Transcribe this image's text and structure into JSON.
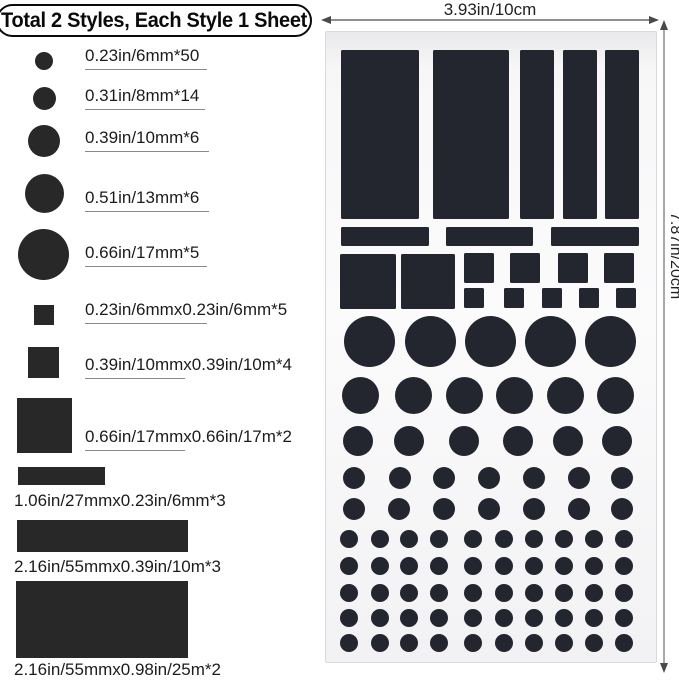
{
  "title": "Total 2 Styles, Each Style 1 Sheet",
  "colors": {
    "sticker": "#23252f",
    "legend_shape": "#282828",
    "text": "#1c1c1c",
    "underline": "#8a8a8a",
    "dimension_line": "#4a4a4a"
  },
  "legend": {
    "items": [
      {
        "label": "0.23in/6mm*50",
        "shape": "circle",
        "w": 18,
        "h": 18,
        "sx": 35,
        "sy": 52,
        "tx": 85,
        "ty": 46,
        "ul": 122
      },
      {
        "label": "0.31in/8mm*14",
        "shape": "circle",
        "w": 23,
        "h": 23,
        "sx": 33,
        "sy": 87,
        "tx": 85,
        "ty": 86,
        "ul": 120
      },
      {
        "label": "0.39in/10mm*6",
        "shape": "circle",
        "w": 32,
        "h": 32,
        "sx": 28,
        "sy": 125,
        "tx": 85,
        "ty": 128,
        "ul": 124
      },
      {
        "label": "0.51in/13mm*6",
        "shape": "circle",
        "w": 39,
        "h": 39,
        "sx": 25,
        "sy": 174,
        "tx": 85,
        "ty": 188,
        "ul": 124
      },
      {
        "label": "0.66in/17mm*5",
        "shape": "circle",
        "w": 51,
        "h": 51,
        "sx": 18,
        "sy": 229,
        "tx": 85,
        "ty": 243,
        "ul": 122
      },
      {
        "label": "0.23in/6mmx0.23in/6mm*5",
        "shape": "square",
        "w": 20,
        "h": 20,
        "sx": 34,
        "sy": 305,
        "tx": 85,
        "ty": 300,
        "ul": 122
      },
      {
        "label": "0.39in/10mmx0.39in/10m*4",
        "shape": "square",
        "w": 31,
        "h": 31,
        "sx": 28,
        "sy": 347,
        "tx": 85,
        "ty": 355,
        "ul": 100
      },
      {
        "label": "0.66in/17mmx0.66in/17m*2",
        "shape": "square",
        "w": 55,
        "h": 55,
        "sx": 17,
        "sy": 398,
        "tx": 85,
        "ty": 427,
        "ul": 100
      },
      {
        "label": "1.06in/27mmx0.23in/6mm*3",
        "shape": "rect",
        "w": 87,
        "h": 18,
        "sx": 18,
        "sy": 467,
        "tx": 14,
        "ty": 491,
        "ul": 0
      },
      {
        "label": "2.16in/55mmx0.39in/10m*3",
        "shape": "rect",
        "w": 171,
        "h": 32,
        "sx": 17,
        "sy": 520,
        "tx": 14,
        "ty": 557,
        "ul": 0
      },
      {
        "label": "2.16in/55mmx0.98in/25m*2",
        "shape": "rect",
        "w": 172,
        "h": 77,
        "sx": 16,
        "sy": 581,
        "tx": 14,
        "ty": 660,
        "ul": 0
      }
    ]
  },
  "sheet": {
    "width_label": "3.93in/10cm",
    "height_label": "7.87in/20cm",
    "rects": [
      {
        "x": 15,
        "y": 18,
        "w": 78,
        "h": 169
      },
      {
        "x": 107,
        "y": 18,
        "w": 76,
        "h": 169
      },
      {
        "x": 194,
        "y": 18,
        "w": 34,
        "h": 169
      },
      {
        "x": 237,
        "y": 18,
        "w": 34,
        "h": 169
      },
      {
        "x": 279,
        "y": 18,
        "w": 34,
        "h": 169
      },
      {
        "x": 15,
        "y": 195,
        "w": 88,
        "h": 19
      },
      {
        "x": 120,
        "y": 195,
        "w": 87,
        "h": 19
      },
      {
        "x": 225,
        "y": 195,
        "w": 88,
        "h": 19
      },
      {
        "x": 14,
        "y": 222,
        "w": 56,
        "h": 55
      },
      {
        "x": 75,
        "y": 222,
        "w": 54,
        "h": 55
      },
      {
        "x": 138,
        "y": 221,
        "w": 30,
        "h": 30
      },
      {
        "x": 184,
        "y": 221,
        "w": 30,
        "h": 30
      },
      {
        "x": 232,
        "y": 221,
        "w": 30,
        "h": 30
      },
      {
        "x": 278,
        "y": 221,
        "w": 30,
        "h": 30
      },
      {
        "x": 138,
        "y": 256,
        "w": 20,
        "h": 20
      },
      {
        "x": 178,
        "y": 256,
        "w": 20,
        "h": 20
      },
      {
        "x": 216,
        "y": 256,
        "w": 20,
        "h": 20
      },
      {
        "x": 253,
        "y": 256,
        "w": 20,
        "h": 20
      },
      {
        "x": 290,
        "y": 256,
        "w": 20,
        "h": 20
      }
    ],
    "circle_rows": [
      {
        "d": 51,
        "cy": 309,
        "cx": [
          43,
          104,
          164,
          224,
          284
        ]
      },
      {
        "d": 37,
        "cy": 363,
        "cx": [
          34,
          87,
          138,
          188,
          239,
          289
        ]
      },
      {
        "d": 30,
        "cy": 409,
        "cx": [
          32,
          83,
          138,
          192,
          242,
          291
        ]
      },
      {
        "d": 22,
        "cy": 446,
        "cx": [
          28,
          74,
          118,
          163,
          208,
          253,
          296
        ]
      },
      {
        "d": 22,
        "cy": 477,
        "cx": [
          28,
          73,
          118,
          163,
          208,
          253,
          296
        ]
      },
      {
        "d": 18,
        "cy": 507,
        "cx": [
          23,
          54,
          83,
          113,
          147,
          178,
          208,
          238,
          268,
          298
        ]
      },
      {
        "d": 18,
        "cy": 534,
        "cx": [
          23,
          54,
          83,
          113,
          147,
          178,
          208,
          238,
          268,
          298
        ]
      },
      {
        "d": 18,
        "cy": 561,
        "cx": [
          23,
          54,
          83,
          113,
          147,
          178,
          208,
          238,
          268,
          298
        ]
      },
      {
        "d": 18,
        "cy": 586,
        "cx": [
          23,
          54,
          83,
          113,
          147,
          178,
          208,
          238,
          268,
          298
        ]
      },
      {
        "d": 18,
        "cy": 611,
        "cx": [
          23,
          54,
          83,
          113,
          147,
          178,
          208,
          238,
          268,
          298
        ]
      }
    ]
  }
}
